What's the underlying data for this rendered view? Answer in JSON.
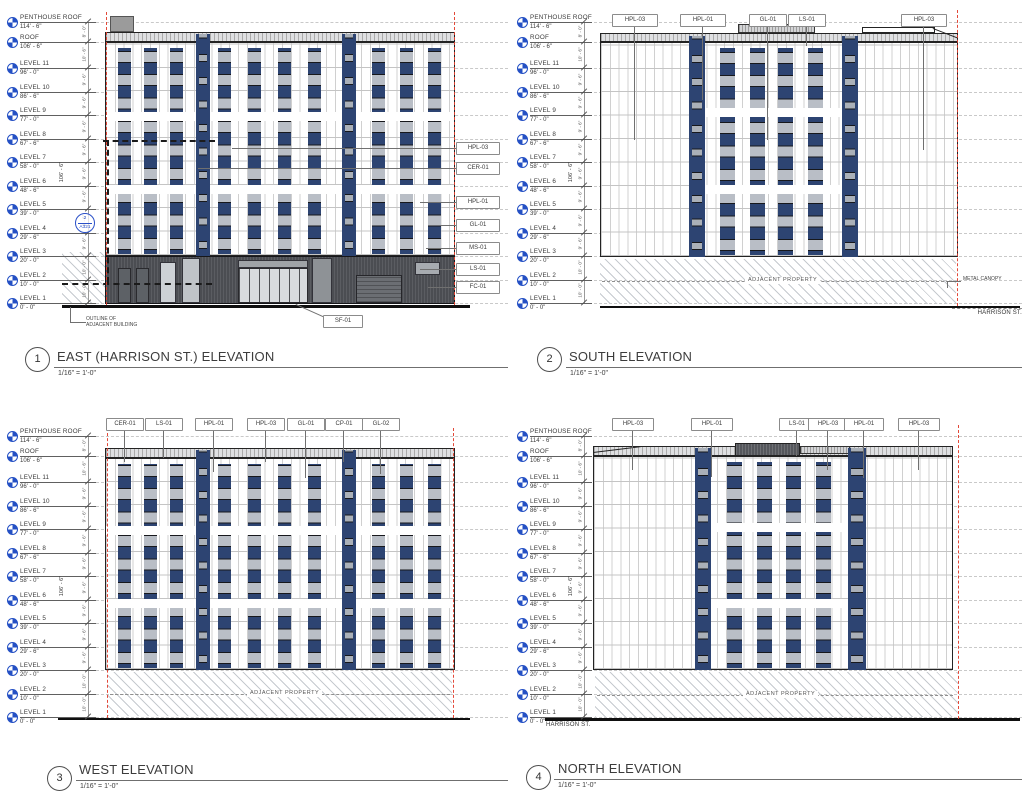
{
  "sheet": {
    "scale": "1/16\" = 1'-0\"",
    "overall_dim": "106' - 6\"",
    "floor_dims": [
      "8' - 0\"",
      "10' - 6\"",
      "9' - 6\"",
      "9' - 6\"",
      "9' - 6\"",
      "9' - 6\"",
      "9' - 6\"",
      "9' - 6\"",
      "9' - 6\"",
      "9' - 6\"",
      "10' - 0\"",
      "10' - 0\""
    ],
    "colors": {
      "panel_blue": "#2d4472",
      "base_gray": "#4b4d52",
      "datum_blue": "#2450c4",
      "property_red": "#e2402f"
    },
    "levels": [
      {
        "name": "PENTHOUSE ROOF",
        "elev": "114' - 6\""
      },
      {
        "name": "ROOF",
        "elev": "106' - 6\""
      },
      {
        "name": "LEVEL 11",
        "elev": "96' - 0\""
      },
      {
        "name": "LEVEL 10",
        "elev": "86' - 6\""
      },
      {
        "name": "LEVEL 9",
        "elev": "77' - 0\""
      },
      {
        "name": "LEVEL 8",
        "elev": "67' - 6\""
      },
      {
        "name": "LEVEL 7",
        "elev": "58' - 0\""
      },
      {
        "name": "LEVEL 6",
        "elev": "48' - 6\""
      },
      {
        "name": "LEVEL 5",
        "elev": "39' - 0\""
      },
      {
        "name": "LEVEL 4",
        "elev": "29' - 6\""
      },
      {
        "name": "LEVEL 3",
        "elev": "20' - 0\""
      },
      {
        "name": "LEVEL 2",
        "elev": "10' - 0\""
      },
      {
        "name": "LEVEL 1",
        "elev": "0' - 0\""
      }
    ],
    "elevations": {
      "east": {
        "number": "1",
        "title": "EAST (HARRISON ST.) ELEVATION",
        "tags_right": [
          "HPL-03",
          "CER-01",
          "HPL-01",
          "GL-01",
          "MS-01",
          "LS-01",
          "FC-01"
        ],
        "tag_sf": "SF-01",
        "detail_num": "2",
        "detail_sheet": "A321",
        "outline_note": "OUTLINE OF\nADJACENT BUILDING"
      },
      "south": {
        "number": "2",
        "title": "SOUTH ELEVATION",
        "tags_top": [
          "HPL-03",
          "HPL-01",
          "GL-01",
          "LS-01",
          "HPL-03"
        ],
        "property_note": "ADJACENT PROPERTY",
        "canopy_note": "METAL CANOPY",
        "street_note": "HARRISON ST."
      },
      "west": {
        "number": "3",
        "title": "WEST ELEVATION",
        "tags_top": [
          "CER-01",
          "LS-01",
          "HPL-01",
          "HPL-03",
          "GL-01",
          "CP-01",
          "GL-02"
        ],
        "property_note": "ADJACENT PROPERTY"
      },
      "north": {
        "number": "4",
        "title": "NORTH ELEVATION",
        "tags_top": [
          "HPL-03",
          "HPL-01",
          "LS-01",
          "HPL-03",
          "HPL-01",
          "HPL-03"
        ],
        "property_note": "ADJACENT PROPERTY",
        "street_note": "HARRISON ST."
      }
    }
  }
}
